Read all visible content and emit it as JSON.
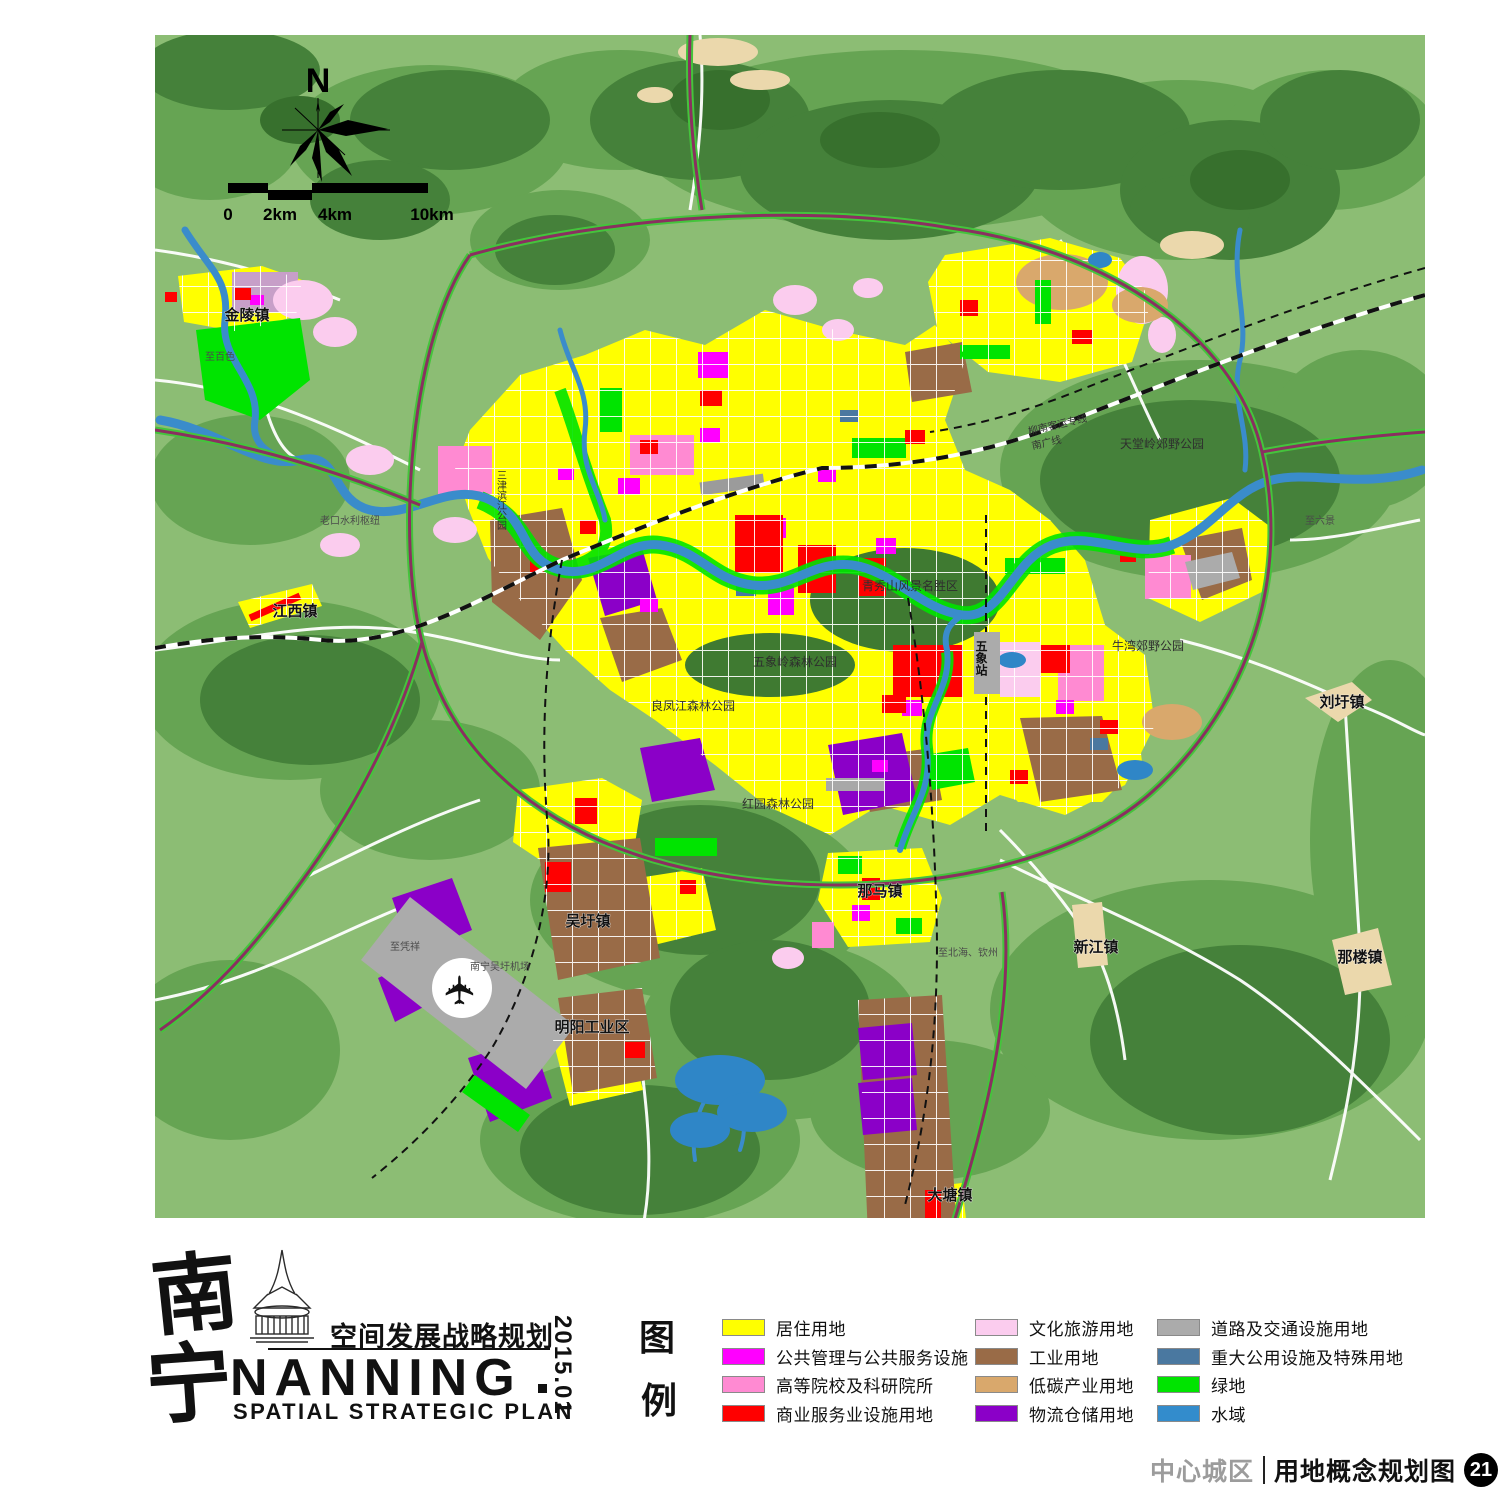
{
  "map": {
    "north_label": "N",
    "scale_ticks": [
      "0",
      "2km",
      "4km",
      "10km"
    ],
    "labels": {
      "jinling_town": "金陵镇",
      "to_baise": "至百色",
      "jiangxi_town": "江西镇",
      "laokou_hub": "老口水利枢纽",
      "sanjin_park": "三津滨江公园",
      "liangfengjiang_park": "良凤江森林公园",
      "hongyuan_park": "红园森林公园",
      "wuxiangling_park": "五象岭森林公园",
      "qingxiushan_area": "青秀山风景名胜区",
      "wuxiang_station": "五象站",
      "niuwan_park": "牛湾郊野公园",
      "tiantangling_park": "天堂岭郊野公园",
      "liunan_rail": "柳南客运专线",
      "nanguang_rail": "南广线",
      "liuwei_town": "刘圩镇",
      "to_liujing": "至六景",
      "nalou_town": "那楼镇",
      "xinjiang_town": "新江镇",
      "nama_town": "那马镇",
      "to_beihai": "至北海、钦州",
      "datang_town": "大塘镇",
      "wuwei_town": "吴圩镇",
      "airport": "南宁吴圩机场",
      "mingyang_zone": "明阳工业区",
      "to_pingxiang": "至凭祥"
    }
  },
  "logo": {
    "cn_char1": "南",
    "cn_char2": "宁",
    "cn_title": "空间发展战略规划",
    "en_name": "NANNING",
    "en_subtitle": "SPATIAL STRATEGIC PLAN",
    "date": "2015.01"
  },
  "legend": {
    "title_char1": "图",
    "title_char2": "例",
    "items": [
      {
        "label": "居住用地",
        "color": "#FFFF00"
      },
      {
        "label": "公共管理与公共服务设施",
        "color": "#FF00FF"
      },
      {
        "label": "高等院校及科研院所",
        "color": "#FF8AD2"
      },
      {
        "label": "商业服务业设施用地",
        "color": "#FF0000"
      },
      {
        "label": "文化旅游用地",
        "color": "#FBCCEE"
      },
      {
        "label": "工业用地",
        "color": "#996B47"
      },
      {
        "label": "低碳产业用地",
        "color": "#D9A86C"
      },
      {
        "label": "物流仓储用地",
        "color": "#8B00C8"
      },
      {
        "label": "道路及交通设施用地",
        "color": "#ABABAB"
      },
      {
        "label": "重大公用设施及特殊用地",
        "color": "#4A78A0"
      },
      {
        "label": "绿地",
        "color": "#00E400"
      },
      {
        "label": "水域",
        "color": "#338CCC"
      }
    ]
  },
  "footer": {
    "district": "中心城区",
    "map_title": "用地概念规划图",
    "page_number": "21"
  }
}
